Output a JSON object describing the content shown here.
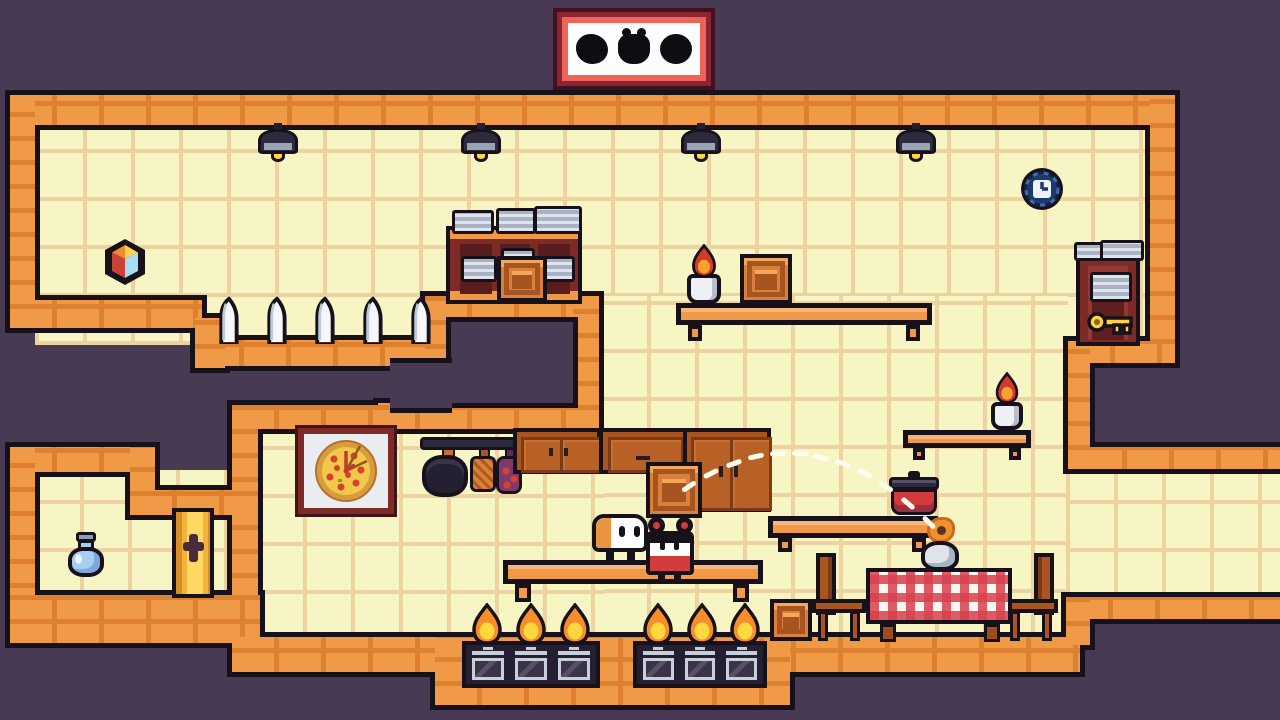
{
  "scene": {
    "name": "kitchen platformer level",
    "view": "2D side-scroller room"
  },
  "colors": {
    "bg": "#473a52",
    "ink": "#16111b",
    "wall": "#f09a47",
    "wallDark": "#dd8030",
    "tile": "#f8f5c5",
    "tileLine": "#eed3a0",
    "maroon": "#7e2b28",
    "maroonDark": "#5f1f20",
    "wood": "#a8551f",
    "woodDark": "#7c3a16",
    "woodLight": "#c9712c",
    "woodPanel": "#b86127",
    "crate": "#d9803a",
    "crateDark": "#a85420",
    "crateLight": "#f2a85c",
    "white": "#fdfdfd",
    "offwhite": "#eef0f4",
    "red": "#d13b3b",
    "redDark": "#9c2f3f",
    "tableRed": "#d8404e",
    "gold": "#f2b23c",
    "goldDark": "#d98f24",
    "keyYellow": "#ffd23e",
    "flameOrange": "#f78e2b",
    "flameYellow": "#ffd83e",
    "flameRed": "#d33a2e",
    "navy": "#2e2a3e",
    "navyDark": "#241f31",
    "navyLight": "#575068",
    "gray": "#aab3c6",
    "grayLight": "#dfe4ec",
    "graySteel": "#c9cfd8",
    "blueDark": "#1d3a6e",
    "blueMid": "#3f6cb0",
    "milk": "#a9cdf0",
    "milkDark": "#8d9fb8",
    "purpleUtensil": "#7e3a6e",
    "skyBlue": "#a8dcf2",
    "hudBorder": "#8c2433",
    "hudInner": "#ef6458",
    "dash": "#fffdf2"
  },
  "hud": {
    "slots": [
      {
        "icon": "collectible-silhouette-round"
      },
      {
        "icon": "collectible-silhouette-jar"
      },
      {
        "icon": "collectible-silhouette-circle"
      }
    ]
  },
  "characters": [
    {
      "name": "toast-buddy",
      "state": "standing on shelf"
    },
    {
      "name": "tomato-chef",
      "state": "carrying wooden crate overhead"
    }
  ],
  "collectibles": [
    "puzzle-cube",
    "wall-clock-token",
    "golden-key",
    "milk-bottle"
  ],
  "fixtures": {
    "lamps_x": [
      255,
      458,
      678,
      893
    ],
    "knives": {
      "count": 5,
      "x": 214,
      "y": 296,
      "width": 220,
      "height": 46
    },
    "stoves": [
      {
        "x": 462,
        "width": 138,
        "ovens": 3,
        "flame_lefts": [
          470,
          514,
          558
        ]
      },
      {
        "x": 633,
        "width": 134,
        "ovens": 3,
        "flame_lefts": [
          641,
          685,
          728
        ]
      }
    ]
  },
  "trajectory": {
    "from": [
      678,
      494
    ],
    "control": [
      812,
      396
    ],
    "to": [
      940,
      534
    ],
    "dashes": 12
  }
}
